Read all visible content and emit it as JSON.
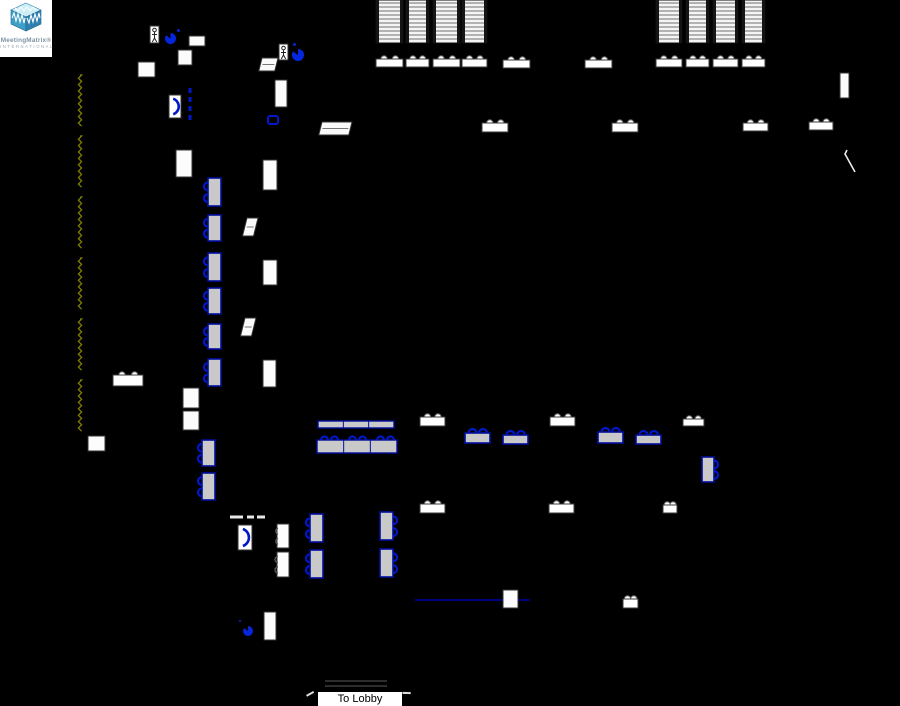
{
  "app": {
    "logo_line1": "MeetingMatrix®",
    "logo_line2": "INTERNATIONAL"
  },
  "labels": {
    "to_lobby": "To Lobby"
  },
  "colors": {
    "background": "#000000",
    "table_fill": "#c9c9c9",
    "table_border": "#000f9e",
    "chair_blue": "#0018c8",
    "white_furniture": "#ffffff",
    "white_stroke": "#3a3a3a",
    "airwall_olive": "#7f7f00",
    "pie_blue": "#0426dd",
    "wall_navy": "#000080",
    "logo_cube_top": "#cdeef6",
    "logo_cube_left": "#3c9fc8",
    "logo_cube_right": "#2f7fb0"
  },
  "floorplan": {
    "width": 900,
    "height": 706,
    "items": [
      {
        "t": "zig",
        "n": "airwall-track",
        "i": false,
        "x": 80,
        "segs": [
          [
            75,
            128
          ],
          [
            136,
            189
          ],
          [
            197,
            250
          ],
          [
            258,
            311
          ],
          [
            319,
            372
          ],
          [
            380,
            433
          ]
        ]
      },
      {
        "t": "hline",
        "n": "wall-line",
        "i": false,
        "x": 415,
        "y": 600,
        "l": 115,
        "c": "#000080",
        "sw": 2
      },
      {
        "t": "hline",
        "n": "step-line",
        "i": false,
        "x": 325,
        "y": 681,
        "l": 62,
        "c": "#3a3a3a",
        "sw": 1.5
      },
      {
        "t": "hline",
        "n": "step-line",
        "i": false,
        "x": 325,
        "y": 686,
        "l": 62,
        "c": "#3a3a3a",
        "sw": 1.5
      },
      {
        "t": "hline",
        "n": "step-mark",
        "i": false,
        "x": 230,
        "y": 517,
        "l": 13,
        "c": "#e8e8e8",
        "sw": 3
      },
      {
        "t": "hline",
        "n": "step-mark",
        "i": false,
        "x": 247,
        "y": 517,
        "l": 7,
        "c": "#e8e8e8",
        "sw": 3
      },
      {
        "t": "hline",
        "n": "step-mark",
        "i": false,
        "x": 257,
        "y": 517,
        "l": 8,
        "c": "#e8e8e8",
        "sw": 3
      },
      {
        "t": "diag",
        "n": "door-swing",
        "i": false,
        "x": 845,
        "y": 150
      },
      {
        "t": "tick",
        "n": "dimension-tick",
        "i": false,
        "x": 306,
        "y": 694,
        "a": -15
      },
      {
        "t": "tick",
        "n": "dimension-tick",
        "i": false,
        "x": 403,
        "y": 691,
        "a": 15
      },
      {
        "t": "door",
        "n": "door",
        "i": true,
        "x": 169,
        "y": 95,
        "w": 12,
        "h": 23
      },
      {
        "t": "door",
        "n": "door",
        "i": true,
        "x": 238,
        "y": 525,
        "w": 14,
        "h": 25
      },
      {
        "t": "ddash",
        "n": "door-threshold",
        "i": false,
        "x": 190,
        "y": 88,
        "l": 34
      },
      {
        "t": "person",
        "n": "person-icon",
        "i": true,
        "x": 150,
        "y": 26,
        "w": 9,
        "h": 17
      },
      {
        "t": "person",
        "n": "person-icon",
        "i": true,
        "x": 279,
        "y": 44,
        "w": 9,
        "h": 16
      },
      {
        "t": "pie",
        "n": "pie-marker-icon",
        "i": true,
        "x": 165,
        "y": 33,
        "w": 11,
        "h": 11
      },
      {
        "t": "pie",
        "n": "pie-marker-icon",
        "i": true,
        "x": 292,
        "y": 49,
        "w": 12,
        "h": 12
      },
      {
        "t": "pie",
        "n": "pie-marker-icon",
        "i": true,
        "x": 243,
        "y": 626,
        "w": 10,
        "h": 10
      },
      {
        "t": "dot",
        "n": "dot-marker",
        "i": false,
        "x": 177,
        "y": 29,
        "w": 3
      },
      {
        "t": "dot",
        "n": "dot-marker",
        "i": false,
        "x": 293,
        "y": 43,
        "w": 3
      },
      {
        "t": "dot",
        "n": "dot-marker",
        "i": false,
        "x": 239,
        "y": 620,
        "w": 2
      },
      {
        "t": "bluerect",
        "n": "equipment-marker",
        "i": true,
        "x": 268,
        "y": 116,
        "w": 10,
        "h": 8
      },
      {
        "t": "stripes",
        "n": "theater-rows",
        "i": true,
        "x": 376,
        "y": 0,
        "w": 27,
        "h": 43
      },
      {
        "t": "stripes",
        "n": "theater-rows",
        "i": true,
        "x": 406,
        "y": 0,
        "w": 23,
        "h": 43
      },
      {
        "t": "stripes",
        "n": "theater-rows",
        "i": true,
        "x": 433,
        "y": 0,
        "w": 27,
        "h": 43
      },
      {
        "t": "stripes",
        "n": "theater-rows",
        "i": true,
        "x": 462,
        "y": 0,
        "w": 25,
        "h": 43
      },
      {
        "t": "stripes",
        "n": "theater-rows",
        "i": true,
        "x": 656,
        "y": 0,
        "w": 26,
        "h": 43
      },
      {
        "t": "stripes",
        "n": "theater-rows",
        "i": true,
        "x": 686,
        "y": 0,
        "w": 23,
        "h": 43
      },
      {
        "t": "stripes",
        "n": "theater-rows",
        "i": true,
        "x": 713,
        "y": 0,
        "w": 25,
        "h": 43
      },
      {
        "t": "stripes",
        "n": "theater-rows",
        "i": true,
        "x": 742,
        "y": 0,
        "w": 23,
        "h": 43
      },
      {
        "t": "tw",
        "n": "classroom-table",
        "i": true,
        "x": 376,
        "y": 56,
        "w": 27,
        "h": 11
      },
      {
        "t": "tw",
        "n": "classroom-table",
        "i": true,
        "x": 406,
        "y": 56,
        "w": 23,
        "h": 11
      },
      {
        "t": "tw",
        "n": "classroom-table",
        "i": true,
        "x": 433,
        "y": 56,
        "w": 27,
        "h": 11
      },
      {
        "t": "tw",
        "n": "classroom-table",
        "i": true,
        "x": 462,
        "y": 56,
        "w": 25,
        "h": 11
      },
      {
        "t": "tw",
        "n": "classroom-table",
        "i": true,
        "x": 503,
        "y": 57,
        "w": 27,
        "h": 11
      },
      {
        "t": "tw",
        "n": "classroom-table",
        "i": true,
        "x": 585,
        "y": 57,
        "w": 27,
        "h": 11
      },
      {
        "t": "tw",
        "n": "classroom-table",
        "i": true,
        "x": 656,
        "y": 56,
        "w": 26,
        "h": 11
      },
      {
        "t": "tw",
        "n": "classroom-table",
        "i": true,
        "x": 686,
        "y": 56,
        "w": 23,
        "h": 11
      },
      {
        "t": "tw",
        "n": "classroom-table",
        "i": true,
        "x": 713,
        "y": 56,
        "w": 25,
        "h": 11
      },
      {
        "t": "tw",
        "n": "classroom-table",
        "i": true,
        "x": 742,
        "y": 56,
        "w": 23,
        "h": 11
      },
      {
        "t": "tw",
        "n": "classroom-table",
        "i": true,
        "x": 482,
        "y": 120,
        "w": 26,
        "h": 12
      },
      {
        "t": "tw",
        "n": "classroom-table",
        "i": true,
        "x": 612,
        "y": 120,
        "w": 26,
        "h": 12
      },
      {
        "t": "tw",
        "n": "classroom-table",
        "i": true,
        "x": 743,
        "y": 120,
        "w": 25,
        "h": 11
      },
      {
        "t": "tw",
        "n": "classroom-table",
        "i": true,
        "x": 809,
        "y": 119,
        "w": 24,
        "h": 11
      },
      {
        "t": "tw",
        "n": "classroom-table",
        "i": true,
        "x": 113,
        "y": 372,
        "w": 30,
        "h": 14
      },
      {
        "t": "tw",
        "n": "classroom-table",
        "i": true,
        "x": 420,
        "y": 414,
        "w": 25,
        "h": 12
      },
      {
        "t": "tw",
        "n": "classroom-table",
        "i": true,
        "x": 550,
        "y": 414,
        "w": 25,
        "h": 12
      },
      {
        "t": "tw",
        "n": "classroom-table",
        "i": true,
        "x": 683,
        "y": 416,
        "w": 21,
        "h": 10
      },
      {
        "t": "tw",
        "n": "classroom-table",
        "i": true,
        "x": 420,
        "y": 501,
        "w": 25,
        "h": 12
      },
      {
        "t": "tw",
        "n": "classroom-table",
        "i": true,
        "x": 549,
        "y": 501,
        "w": 25,
        "h": 12
      },
      {
        "t": "tw",
        "n": "classroom-table",
        "i": true,
        "x": 663,
        "y": 502,
        "w": 14,
        "h": 11
      },
      {
        "t": "tw",
        "n": "classroom-table",
        "i": true,
        "x": 623,
        "y": 596,
        "w": 15,
        "h": 12
      },
      {
        "t": "twv",
        "n": "furniture-block",
        "i": true,
        "x": 176,
        "y": 150,
        "w": 16,
        "h": 27
      },
      {
        "t": "twv",
        "n": "furniture-block",
        "i": true,
        "x": 263,
        "y": 160,
        "w": 14,
        "h": 30
      },
      {
        "t": "twv",
        "n": "furniture-block",
        "i": true,
        "x": 263,
        "y": 260,
        "w": 14,
        "h": 25
      },
      {
        "t": "twv",
        "n": "furniture-block",
        "i": true,
        "x": 263,
        "y": 360,
        "w": 13,
        "h": 27
      },
      {
        "t": "twv",
        "n": "furniture-block",
        "i": true,
        "x": 275,
        "y": 80,
        "w": 12,
        "h": 27
      },
      {
        "t": "twv",
        "n": "furniture-block",
        "i": true,
        "x": 183,
        "y": 388,
        "w": 16,
        "h": 20
      },
      {
        "t": "twv",
        "n": "furniture-block",
        "i": true,
        "x": 183,
        "y": 411,
        "w": 16,
        "h": 19
      },
      {
        "t": "twv",
        "n": "furniture-block",
        "i": true,
        "x": 88,
        "y": 436,
        "w": 17,
        "h": 15
      },
      {
        "t": "twv",
        "n": "furniture-block",
        "i": true,
        "x": 138,
        "y": 62,
        "w": 17,
        "h": 15
      },
      {
        "t": "twv",
        "n": "furniture-block",
        "i": true,
        "x": 178,
        "y": 50,
        "w": 14,
        "h": 15
      },
      {
        "t": "twv",
        "n": "furniture-block",
        "i": true,
        "x": 189,
        "y": 36,
        "w": 16,
        "h": 10
      },
      {
        "t": "twv",
        "n": "furniture-block",
        "i": true,
        "x": 503,
        "y": 590,
        "w": 15,
        "h": 18
      },
      {
        "t": "twv",
        "n": "furniture-block",
        "i": true,
        "x": 264,
        "y": 612,
        "w": 12,
        "h": 28
      },
      {
        "t": "twv",
        "n": "furniture-block",
        "i": true,
        "x": 840,
        "y": 73,
        "w": 9,
        "h": 25
      },
      {
        "t": "twvc",
        "n": "table-with-chairs-white",
        "i": true,
        "x": 277,
        "y": 524,
        "w": 12,
        "h": 24
      },
      {
        "t": "twvc",
        "n": "table-with-chairs-white",
        "i": true,
        "x": 277,
        "y": 552,
        "w": 12,
        "h": 25
      },
      {
        "t": "twp",
        "n": "skewed-table",
        "i": true,
        "x": 262,
        "y": 58,
        "w": 16,
        "h": 13
      },
      {
        "t": "twp",
        "n": "skewed-table",
        "i": true,
        "x": 247,
        "y": 218,
        "w": 11,
        "h": 18
      },
      {
        "t": "twp",
        "n": "skewed-table",
        "i": true,
        "x": 245,
        "y": 318,
        "w": 11,
        "h": 18
      },
      {
        "t": "twp",
        "n": "skewed-table",
        "i": true,
        "x": 322,
        "y": 122,
        "w": 30,
        "h": 13
      },
      {
        "t": "tg",
        "n": "banquet-table",
        "i": true,
        "x": 203,
        "y": 178,
        "w": 13,
        "h": 28
      },
      {
        "t": "tg",
        "n": "banquet-table",
        "i": true,
        "x": 203,
        "y": 215,
        "w": 13,
        "h": 26
      },
      {
        "t": "tg",
        "n": "banquet-table",
        "i": true,
        "x": 203,
        "y": 253,
        "w": 13,
        "h": 28
      },
      {
        "t": "tg",
        "n": "banquet-table",
        "i": true,
        "x": 203,
        "y": 288,
        "w": 13,
        "h": 26
      },
      {
        "t": "tg",
        "n": "banquet-table",
        "i": true,
        "x": 203,
        "y": 324,
        "w": 13,
        "h": 25
      },
      {
        "t": "tg",
        "n": "banquet-table",
        "i": true,
        "x": 203,
        "y": 359,
        "w": 13,
        "h": 27
      },
      {
        "t": "tg",
        "n": "banquet-table",
        "i": true,
        "x": 197,
        "y": 440,
        "w": 13,
        "h": 26
      },
      {
        "t": "tg",
        "n": "banquet-table",
        "i": true,
        "x": 197,
        "y": 473,
        "w": 13,
        "h": 27
      },
      {
        "t": "tg",
        "n": "banquet-table",
        "i": true,
        "x": 305,
        "y": 514,
        "w": 13,
        "h": 28
      },
      {
        "t": "tg",
        "n": "banquet-table",
        "i": true,
        "x": 305,
        "y": 550,
        "w": 13,
        "h": 28
      },
      {
        "t": "tgr",
        "n": "banquet-table",
        "i": true,
        "x": 380,
        "y": 512,
        "w": 13,
        "h": 28
      },
      {
        "t": "tgr",
        "n": "banquet-table",
        "i": true,
        "x": 380,
        "y": 549,
        "w": 13,
        "h": 28
      },
      {
        "t": "tgr",
        "n": "banquet-table",
        "i": true,
        "x": 702,
        "y": 457,
        "w": 12,
        "h": 25
      },
      {
        "t": "tgh",
        "n": "banquet-table",
        "i": true,
        "x": 465,
        "y": 429,
        "w": 25,
        "h": 14
      },
      {
        "t": "tgh",
        "n": "banquet-table",
        "i": true,
        "x": 503,
        "y": 431,
        "w": 25,
        "h": 13
      },
      {
        "t": "tgh",
        "n": "banquet-table",
        "i": true,
        "x": 598,
        "y": 428,
        "w": 25,
        "h": 15
      },
      {
        "t": "tgh",
        "n": "banquet-table",
        "i": true,
        "x": 636,
        "y": 431,
        "w": 25,
        "h": 13
      },
      {
        "t": "bar",
        "n": "head-table",
        "i": true,
        "x": 318,
        "y": 421,
        "w": 76,
        "h": 7
      },
      {
        "t": "bar",
        "n": "head-table",
        "i": true,
        "x": 317,
        "y": 440,
        "w": 80,
        "h": 13
      },
      {
        "t": "chairsrow",
        "n": "chair-row",
        "i": true,
        "x": 321,
        "y": 440,
        "offs": [
          0,
          10,
          28,
          38,
          56,
          66
        ]
      }
    ]
  }
}
